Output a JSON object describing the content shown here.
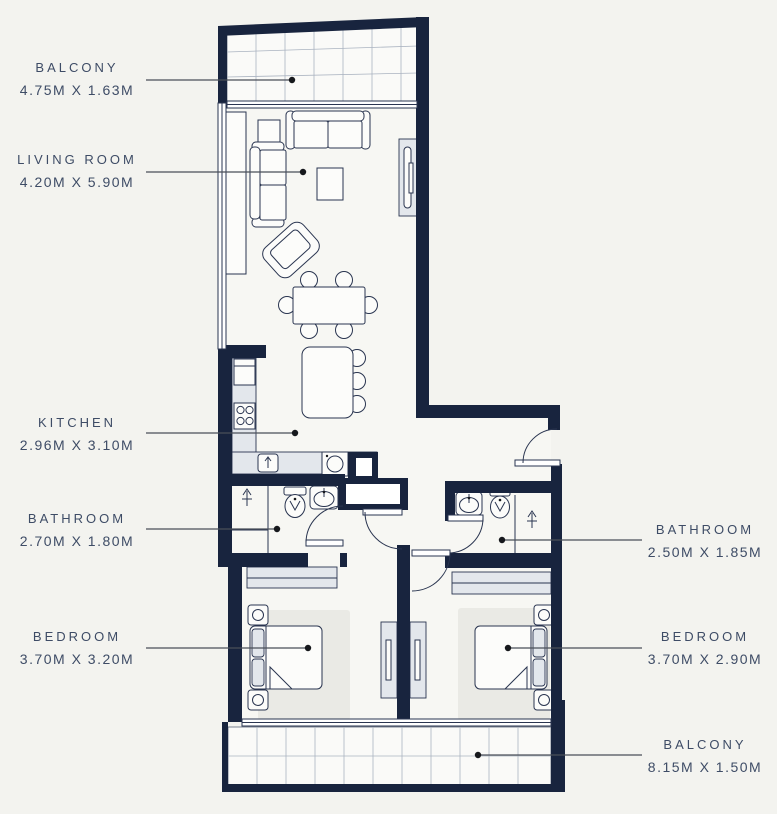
{
  "labels": {
    "left": [
      {
        "name": "BALCONY",
        "dims": "4.75M X 1.63M"
      },
      {
        "name": "LIVING ROOM",
        "dims": "4.20M X 5.90M"
      },
      {
        "name": "KITCHEN",
        "dims": "2.96M X 3.10M"
      },
      {
        "name": "BATHROOM",
        "dims": "2.70M X 1.80M"
      },
      {
        "name": "BEDROOM",
        "dims": "3.70M X 3.20M"
      }
    ],
    "right": [
      {
        "name": "BATHROOM",
        "dims": "2.50M X 1.85M"
      },
      {
        "name": "BEDROOM",
        "dims": "3.70M X 2.90M"
      },
      {
        "name": "BALCONY",
        "dims": "8.15M X 1.50M"
      }
    ]
  },
  "colors": {
    "background": "#f3f3ef",
    "wall": "#18243e",
    "label_text": "#3e4c66",
    "counter_fill": "#e3e7ec",
    "rug_fill": "#eaeae5",
    "leader_line": "#4a4f59"
  }
}
